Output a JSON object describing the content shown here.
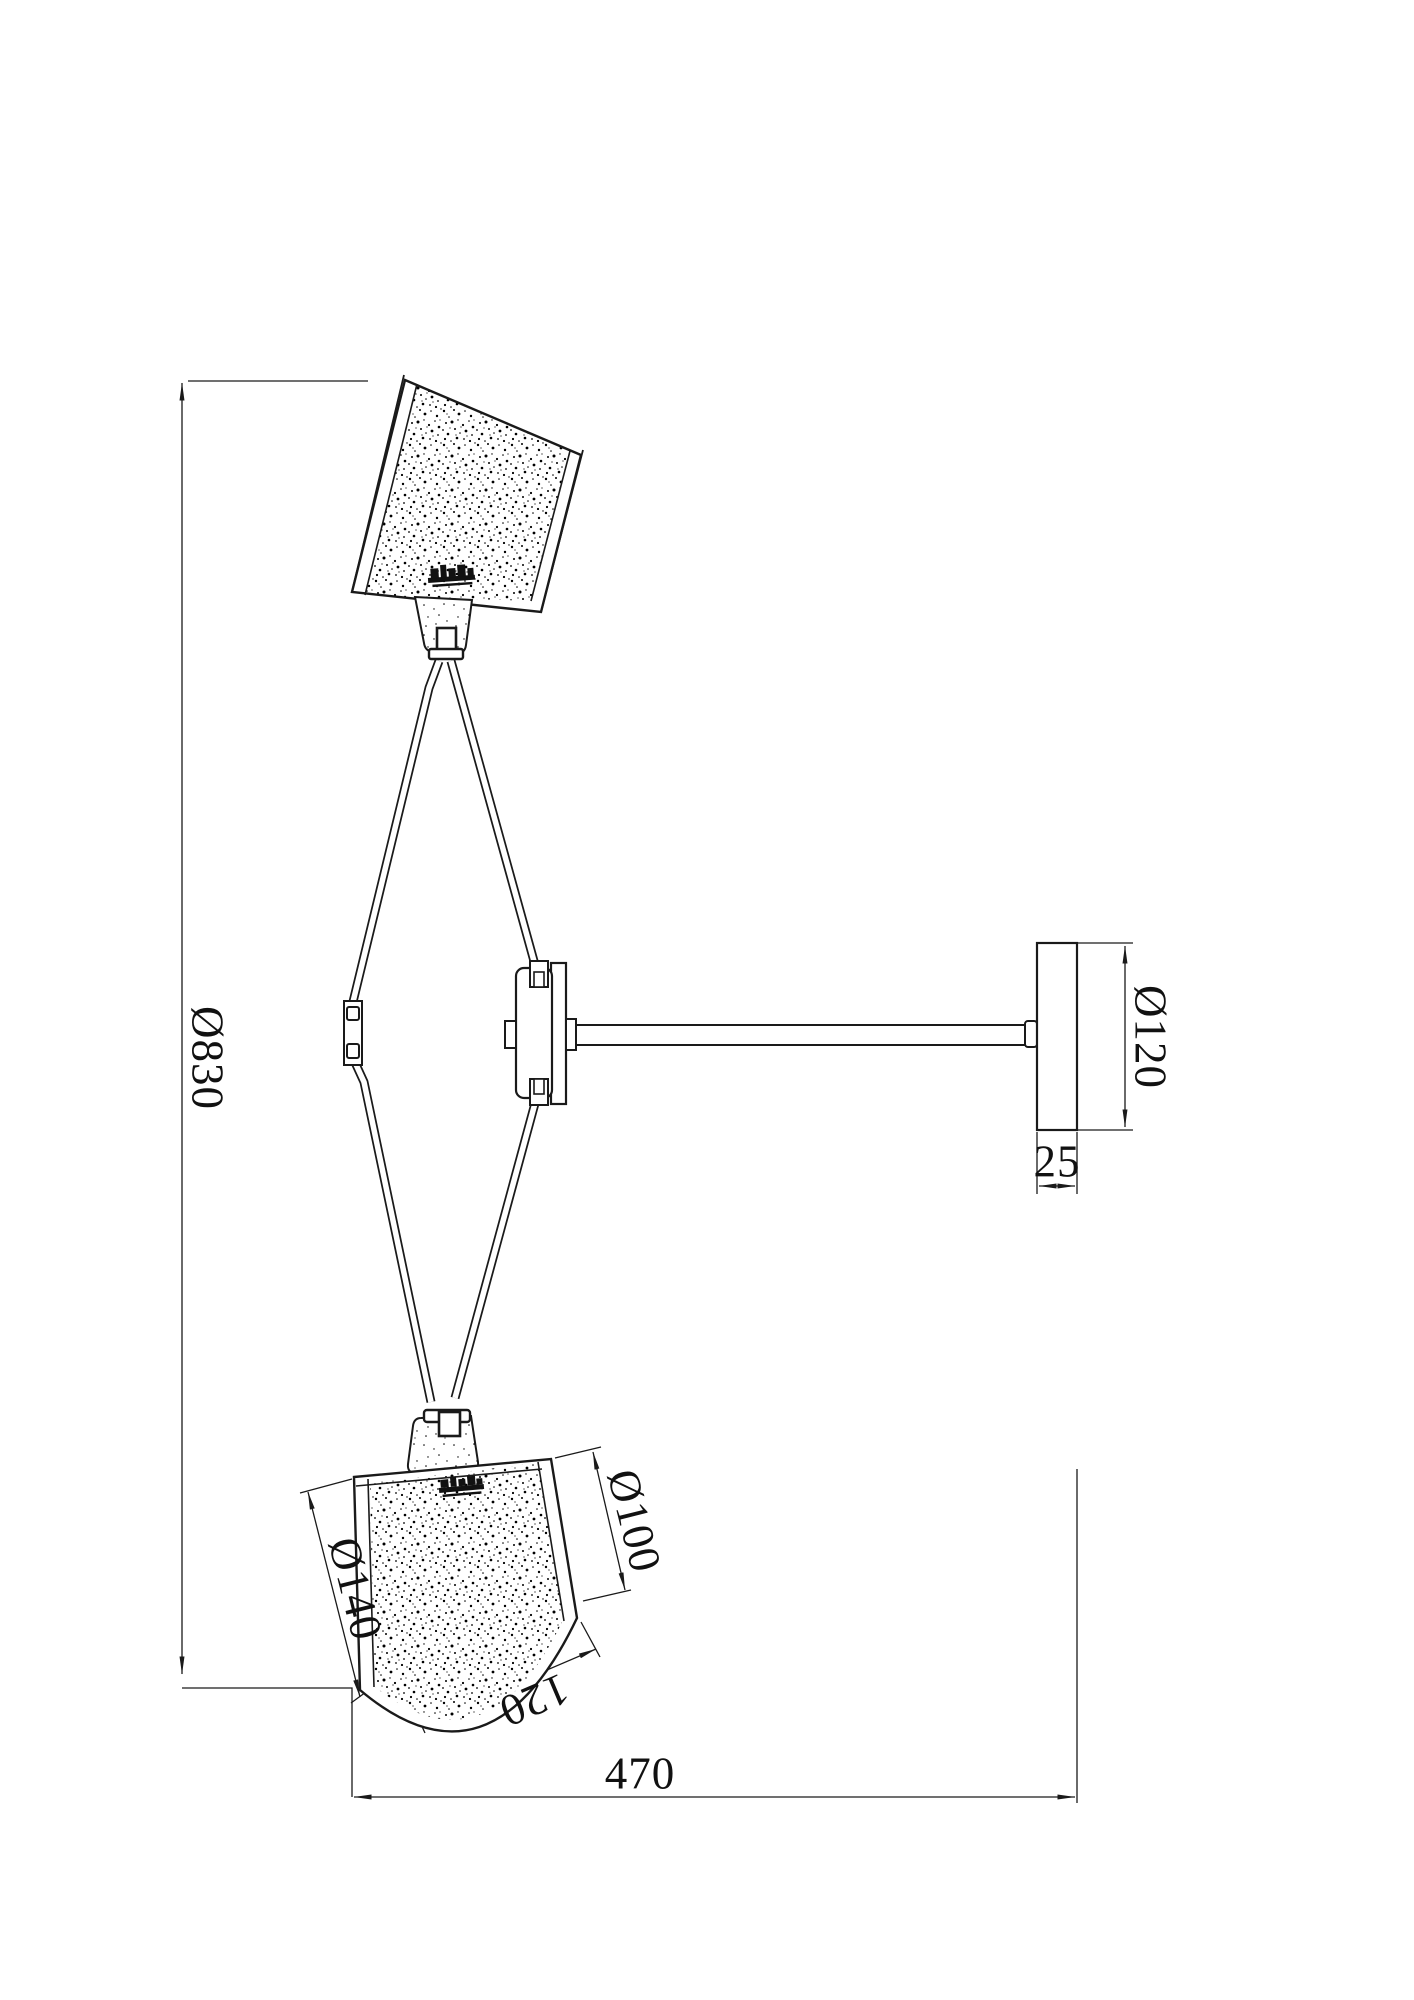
{
  "drawing": {
    "type": "technical-dimension-drawing",
    "subject": "two-shade wall lamp side elevation",
    "units_shown": "mm",
    "colors": {
      "line": "#1a1a1a",
      "background": "#ffffff",
      "text": "#111111"
    },
    "dims": {
      "overall_height": "Ø830",
      "backplate_diameter": "Ø120",
      "backplate_thickness": "25",
      "projection_width": "470",
      "shade_large_diameter": "Ø140",
      "shade_small_diameter": "Ø100",
      "shade_height": "120"
    }
  }
}
